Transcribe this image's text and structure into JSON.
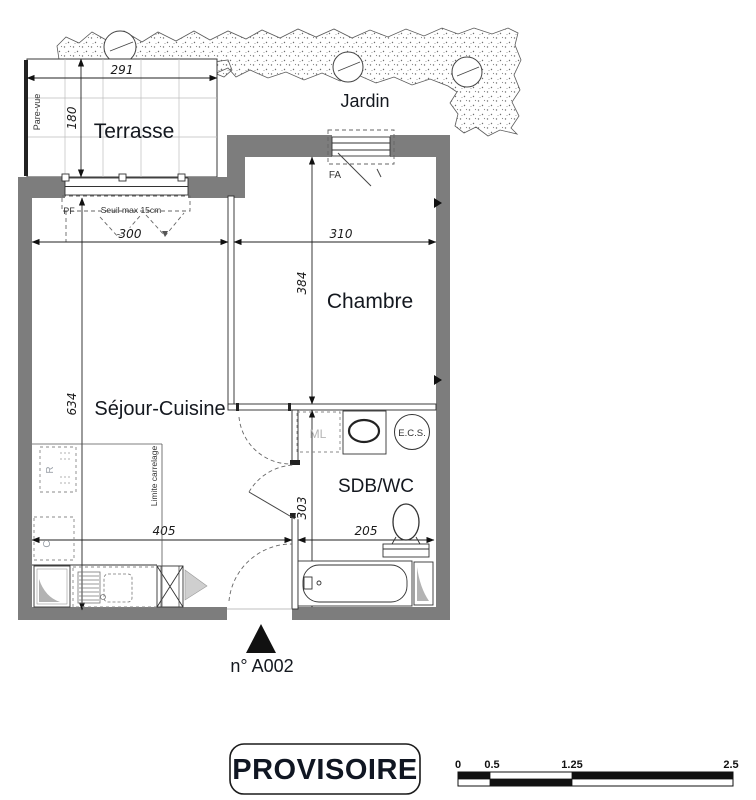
{
  "plan": {
    "rooms": {
      "terrasse": "Terrasse",
      "jardin": "Jardin",
      "chambre": "Chambre",
      "sejour_cuisine": "Séjour-Cuisine",
      "sdb_wc": "SDB/WC"
    },
    "dims": {
      "terrace_w": "291",
      "terrace_d": "180",
      "sejour_w": "300",
      "chambre_w": "310",
      "chambre_d": "384",
      "sejour_d": "634",
      "sejour_lower_w": "405",
      "sdb_w": "205",
      "sdb_d": "303"
    },
    "annotations": {
      "pare_vue": "Pare-vue",
      "pf": "PF",
      "seuil": "Seuil max 15cm",
      "fa": "FA",
      "ml": "ML",
      "ecs": "E.C.S.",
      "fridge": "R",
      "cooker": "C",
      "limite_carrelage": "Limite carrelage"
    },
    "entrance_label": "n° A002"
  },
  "footer": {
    "stamp": "PROVISOIRE",
    "scale_bar": {
      "t0": "0",
      "t1": "0.5",
      "t2": "1.25",
      "t3": "2.5"
    }
  },
  "colors": {
    "wall": "#7d7d7d",
    "line": "#222222",
    "label_text": "#14181f",
    "muted_text": "#b5b5b5"
  }
}
